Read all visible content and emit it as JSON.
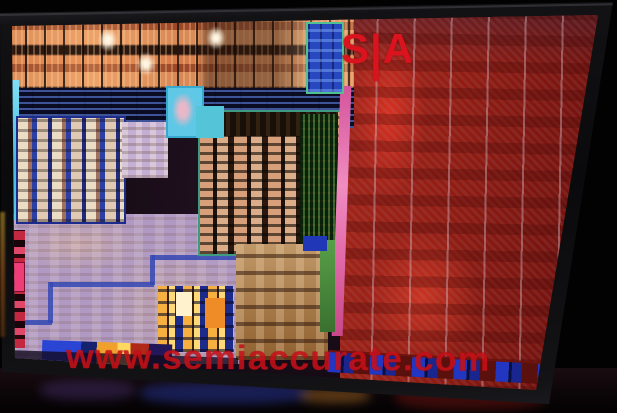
{
  "overlay": {
    "logo": {
      "s": "S",
      "pipe": "|",
      "a": "A",
      "color": "#d9141f"
    },
    "watermark": {
      "text": "www.semiaccurate.com",
      "color": "#c61018"
    }
  },
  "palette": {
    "background": "#000000",
    "bezel": "#131316",
    "gpu_red": "#9e1f16",
    "core_block_orange": "#d98a4e",
    "cache_blue": "#1a2458",
    "uncore_lavender": "#b09ac4",
    "cyan_accent": "#55c9e9",
    "pink_seam": "#e068a8",
    "cpu_core_cream": "#e9d9c4",
    "io_yellow": "#f6b040",
    "green_strip": "#58a048"
  }
}
